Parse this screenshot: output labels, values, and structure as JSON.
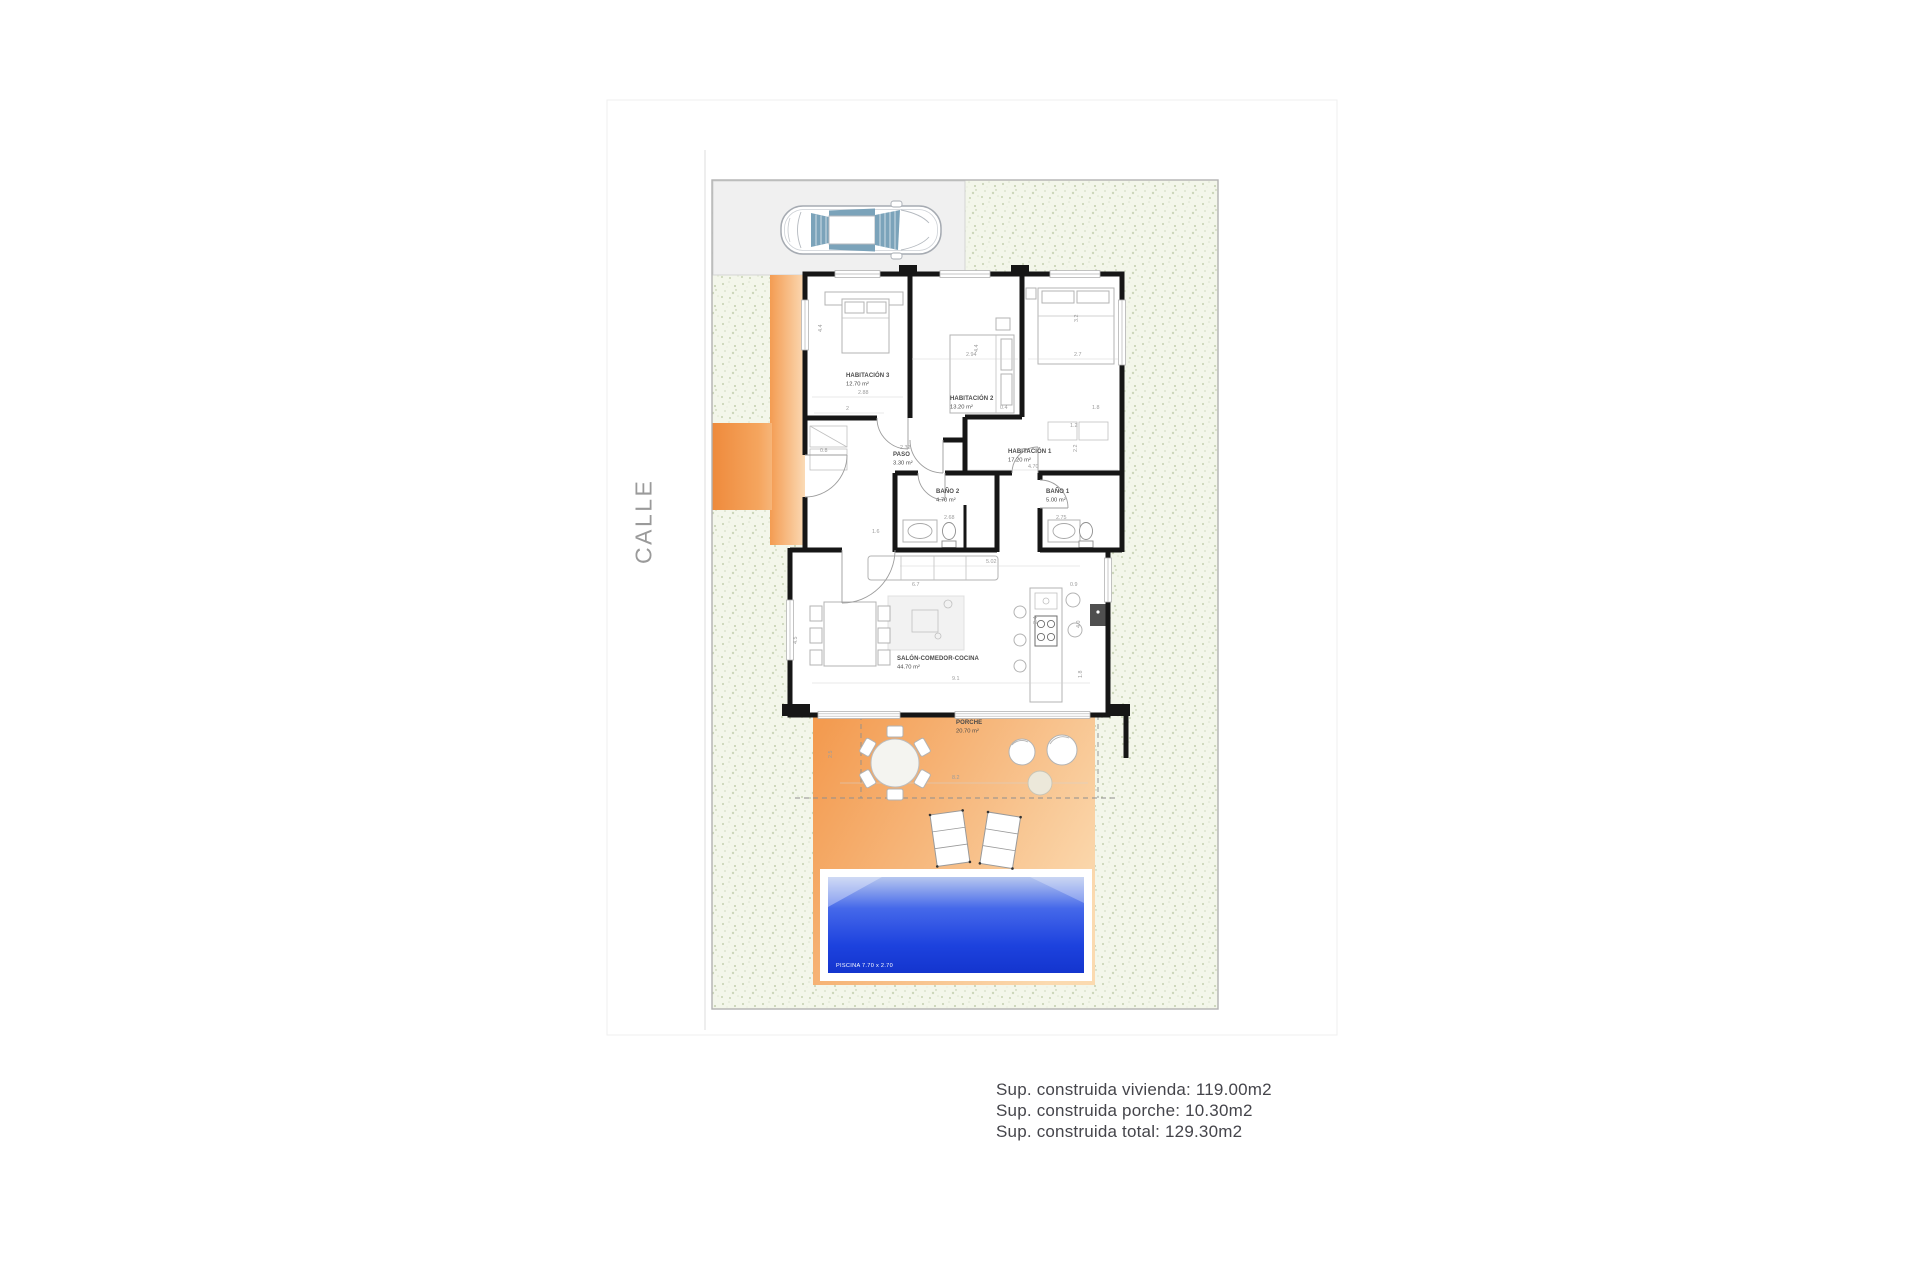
{
  "street": {
    "label": "CALLE"
  },
  "summary": {
    "lines": [
      "Sup. construida vivienda: 119.00m2",
      "Sup. construida porche: 10.30m2",
      "Sup. construida total: 129.30m2"
    ]
  },
  "plan": {
    "rooms": [
      {
        "id": "habitacion-3",
        "name": "HABITACIÓN 3",
        "area": "12.70 m²",
        "x": 846,
        "y": 377
      },
      {
        "id": "habitacion-2",
        "name": "HABITACIÓN 2",
        "area": "13.20 m²",
        "x": 950,
        "y": 400
      },
      {
        "id": "habitacion-1",
        "name": "HABITACIÓN 1",
        "area": "17.20 m²",
        "x": 1008,
        "y": 453
      },
      {
        "id": "paso",
        "name": "PASO",
        "area": "3.30 m²",
        "x": 893,
        "y": 456
      },
      {
        "id": "bano-2",
        "name": "BAÑO 2",
        "area": "4.70 m²",
        "x": 936,
        "y": 493
      },
      {
        "id": "bano-1",
        "name": "BAÑO 1",
        "area": "5.00 m²",
        "x": 1046,
        "y": 493
      },
      {
        "id": "salon",
        "name": "SALÓN-COMEDOR-COCINA",
        "area": "44.70 m²",
        "x": 897,
        "y": 660
      },
      {
        "id": "porche",
        "name": "PORCHE",
        "area": "20.70 m²",
        "x": 956,
        "y": 724
      }
    ],
    "pool_label": "PISCINA 7.70 x 2.70",
    "dims": [
      {
        "t": "2.94",
        "x": 966,
        "y": 356
      },
      {
        "t": "2.7",
        "x": 1074,
        "y": 356
      },
      {
        "t": "4.4",
        "x": 822,
        "y": 332,
        "rot": -90
      },
      {
        "t": "4.4",
        "x": 978,
        "y": 352,
        "rot": -90
      },
      {
        "t": "3.2",
        "x": 1078,
        "y": 322,
        "rot": -90
      },
      {
        "t": "2.88",
        "x": 858,
        "y": 394
      },
      {
        "t": "2",
        "x": 846,
        "y": 410
      },
      {
        "t": "0.8",
        "x": 820,
        "y": 452
      },
      {
        "t": "2.32",
        "x": 900,
        "y": 449
      },
      {
        "t": "0.4",
        "x": 1000,
        "y": 409
      },
      {
        "t": "1.8",
        "x": 1092,
        "y": 409
      },
      {
        "t": "1.2",
        "x": 1070,
        "y": 427
      },
      {
        "t": "2.2",
        "x": 1077,
        "y": 452,
        "rot": -90
      },
      {
        "t": "4.70",
        "x": 1028,
        "y": 468
      },
      {
        "t": "2.68",
        "x": 944,
        "y": 519
      },
      {
        "t": "2.75",
        "x": 1056,
        "y": 519
      },
      {
        "t": "1.6",
        "x": 872,
        "y": 533
      },
      {
        "t": "5.02",
        "x": 986,
        "y": 563
      },
      {
        "t": "6.7",
        "x": 912,
        "y": 586
      },
      {
        "t": "0.9",
        "x": 1070,
        "y": 586
      },
      {
        "t": "2.4",
        "x": 1037,
        "y": 624,
        "rot": -90
      },
      {
        "t": "4.0",
        "x": 1080,
        "y": 628,
        "rot": -90
      },
      {
        "t": "4.5",
        "x": 797,
        "y": 644,
        "rot": -90
      },
      {
        "t": "9.1",
        "x": 952,
        "y": 680
      },
      {
        "t": "1.8",
        "x": 1082,
        "y": 678,
        "rot": -90
      },
      {
        "t": "2.5",
        "x": 832,
        "y": 758,
        "rot": -90
      },
      {
        "t": "8.2",
        "x": 952,
        "y": 779
      }
    ]
  },
  "colors": {
    "accent_orange": "#f29a50",
    "grass_base": "#f3f6ea",
    "pool_blue": "#1d42de",
    "wall": "#161616",
    "driveway": "#f0f0f0",
    "street_text": "#9a9a9a",
    "summary_text": "#45454b"
  }
}
